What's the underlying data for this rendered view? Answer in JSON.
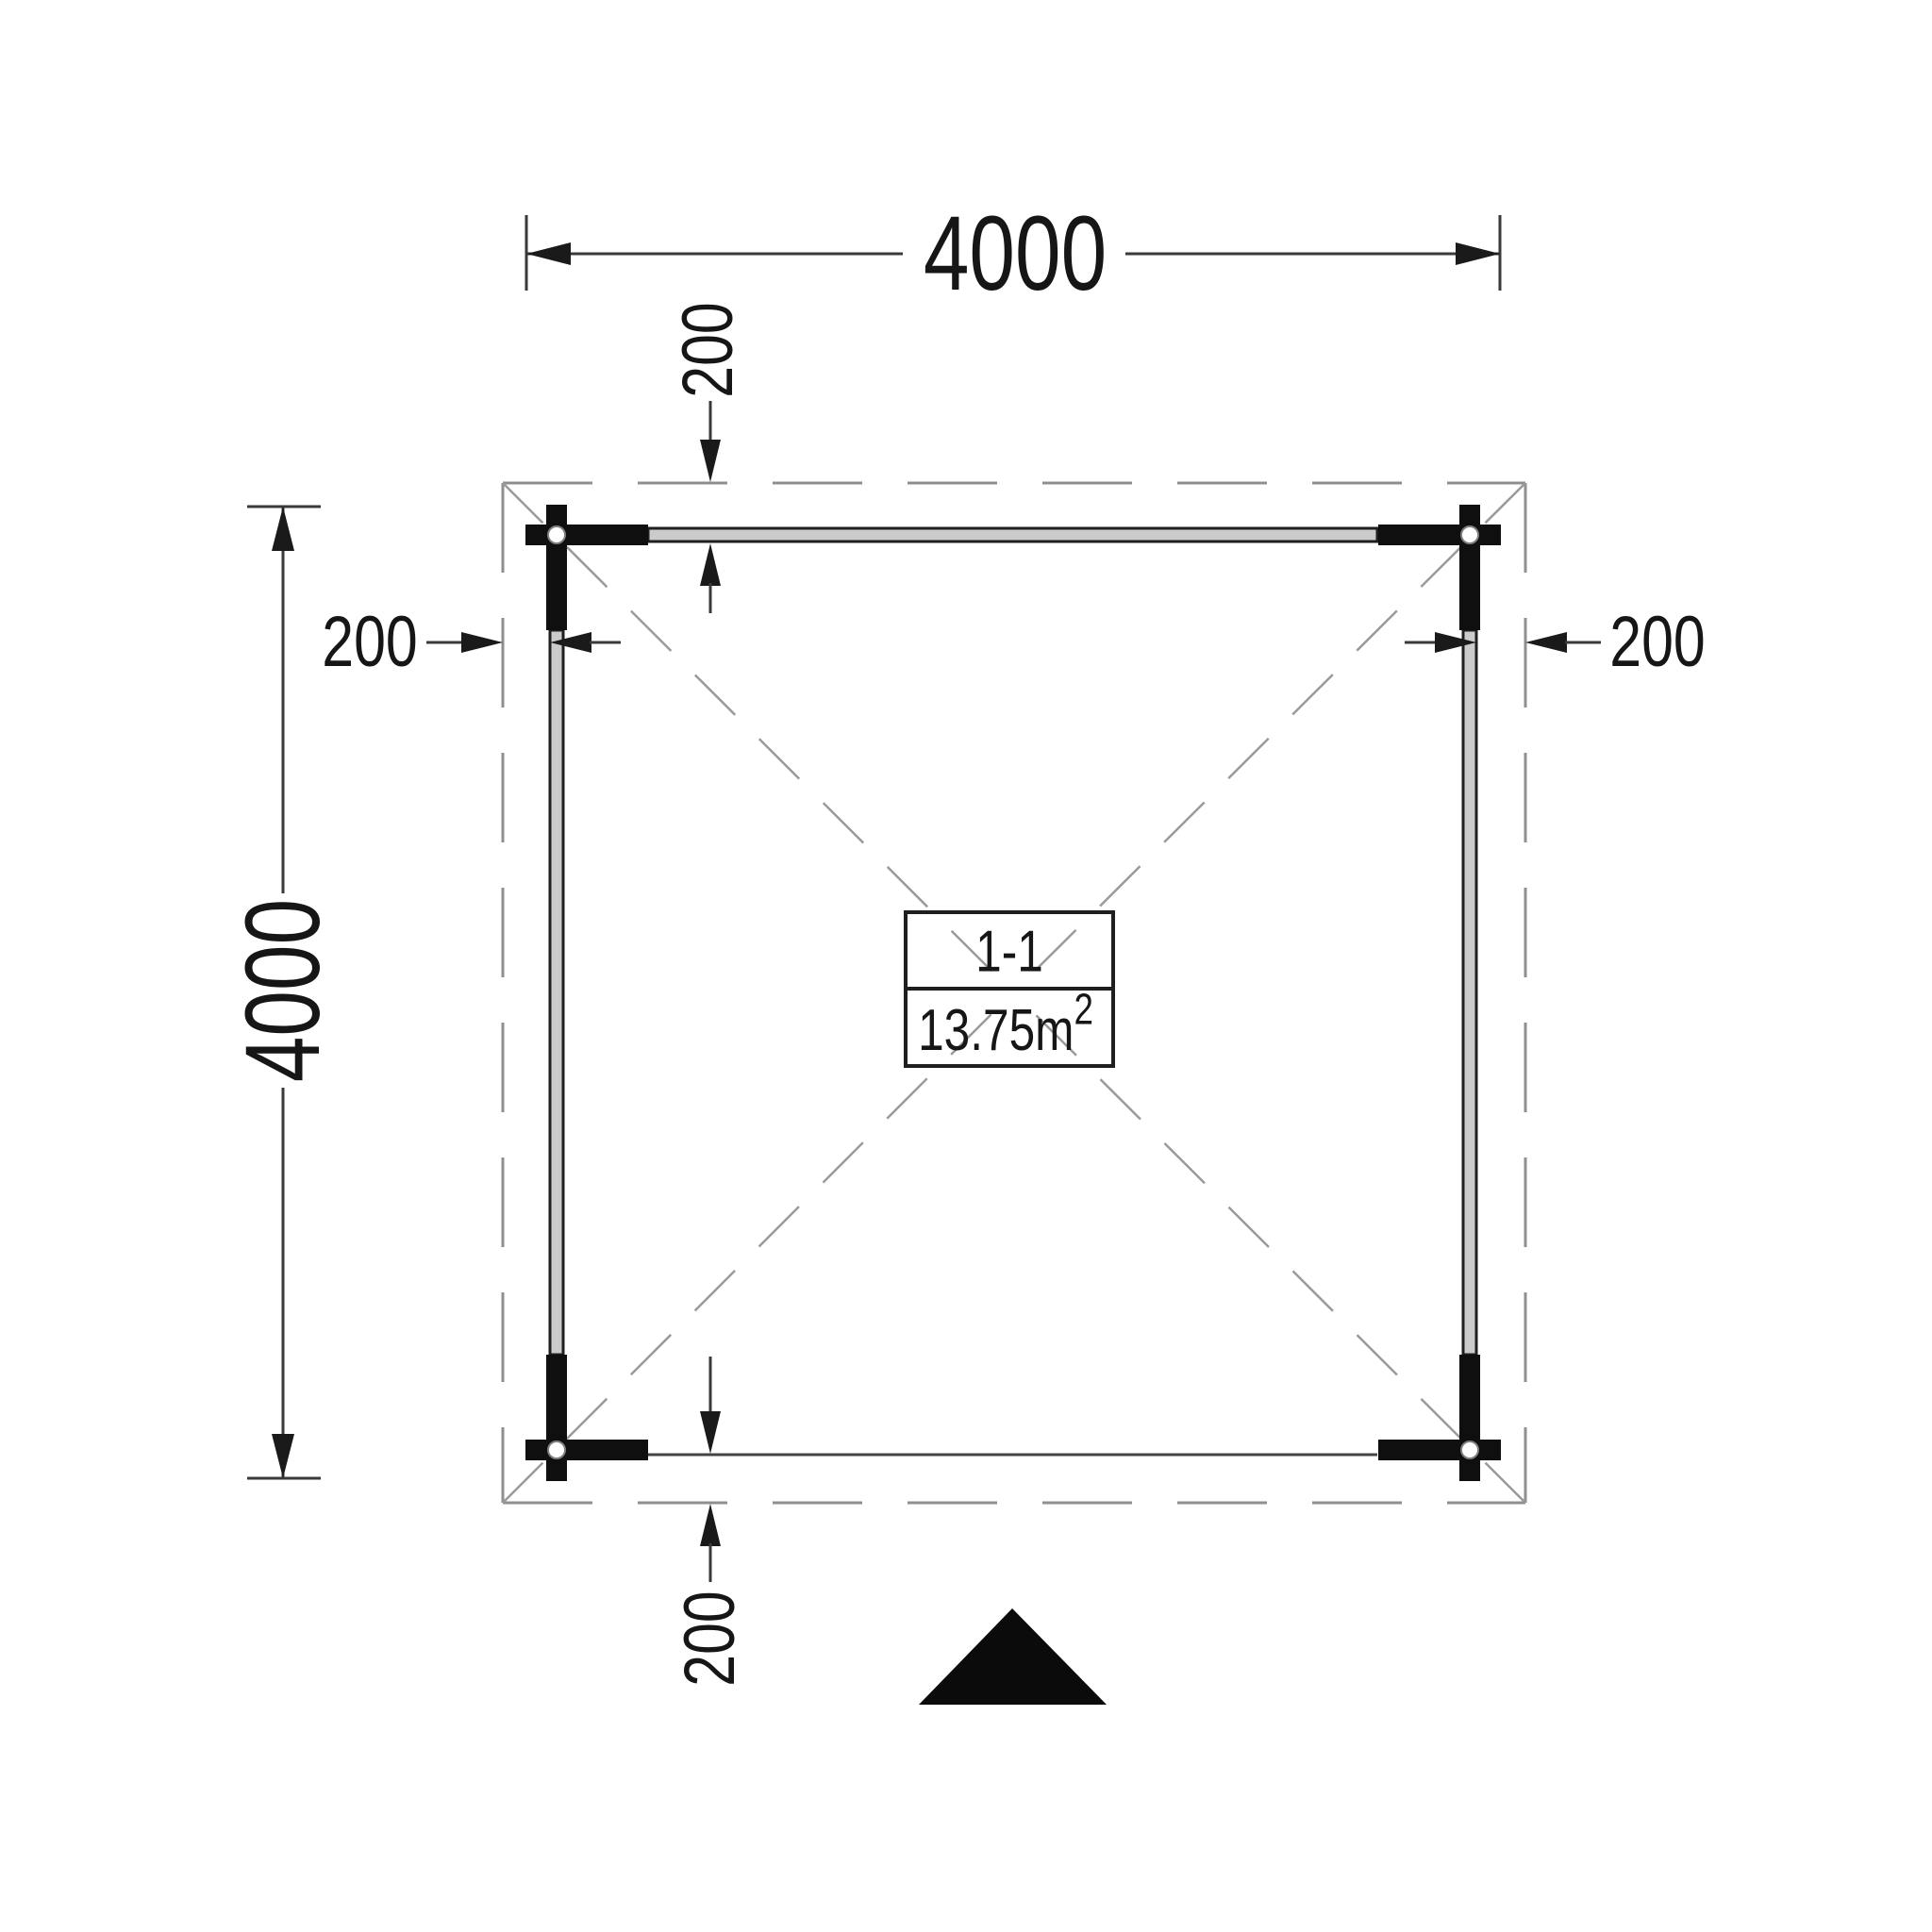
{
  "dimensions": {
    "width_top": "4000",
    "height_left": "4000",
    "overhang_top": "200",
    "overhang_left": "200",
    "overhang_right": "200",
    "overhang_bottom": "200"
  },
  "room_label": {
    "section": "1-1",
    "area": "13.75m",
    "area_superscript": "2"
  },
  "icons": {
    "north_marker": "solid-black-triangle",
    "corner_post": "crossed-log-joint-with-circle"
  },
  "colors": {
    "line_dark": "#1a1a1a",
    "dim_line": "#3a3a3a",
    "dashed_gray": "#8f8f8f",
    "wall_fill": "#cbcbcb",
    "background": "#ffffff"
  }
}
